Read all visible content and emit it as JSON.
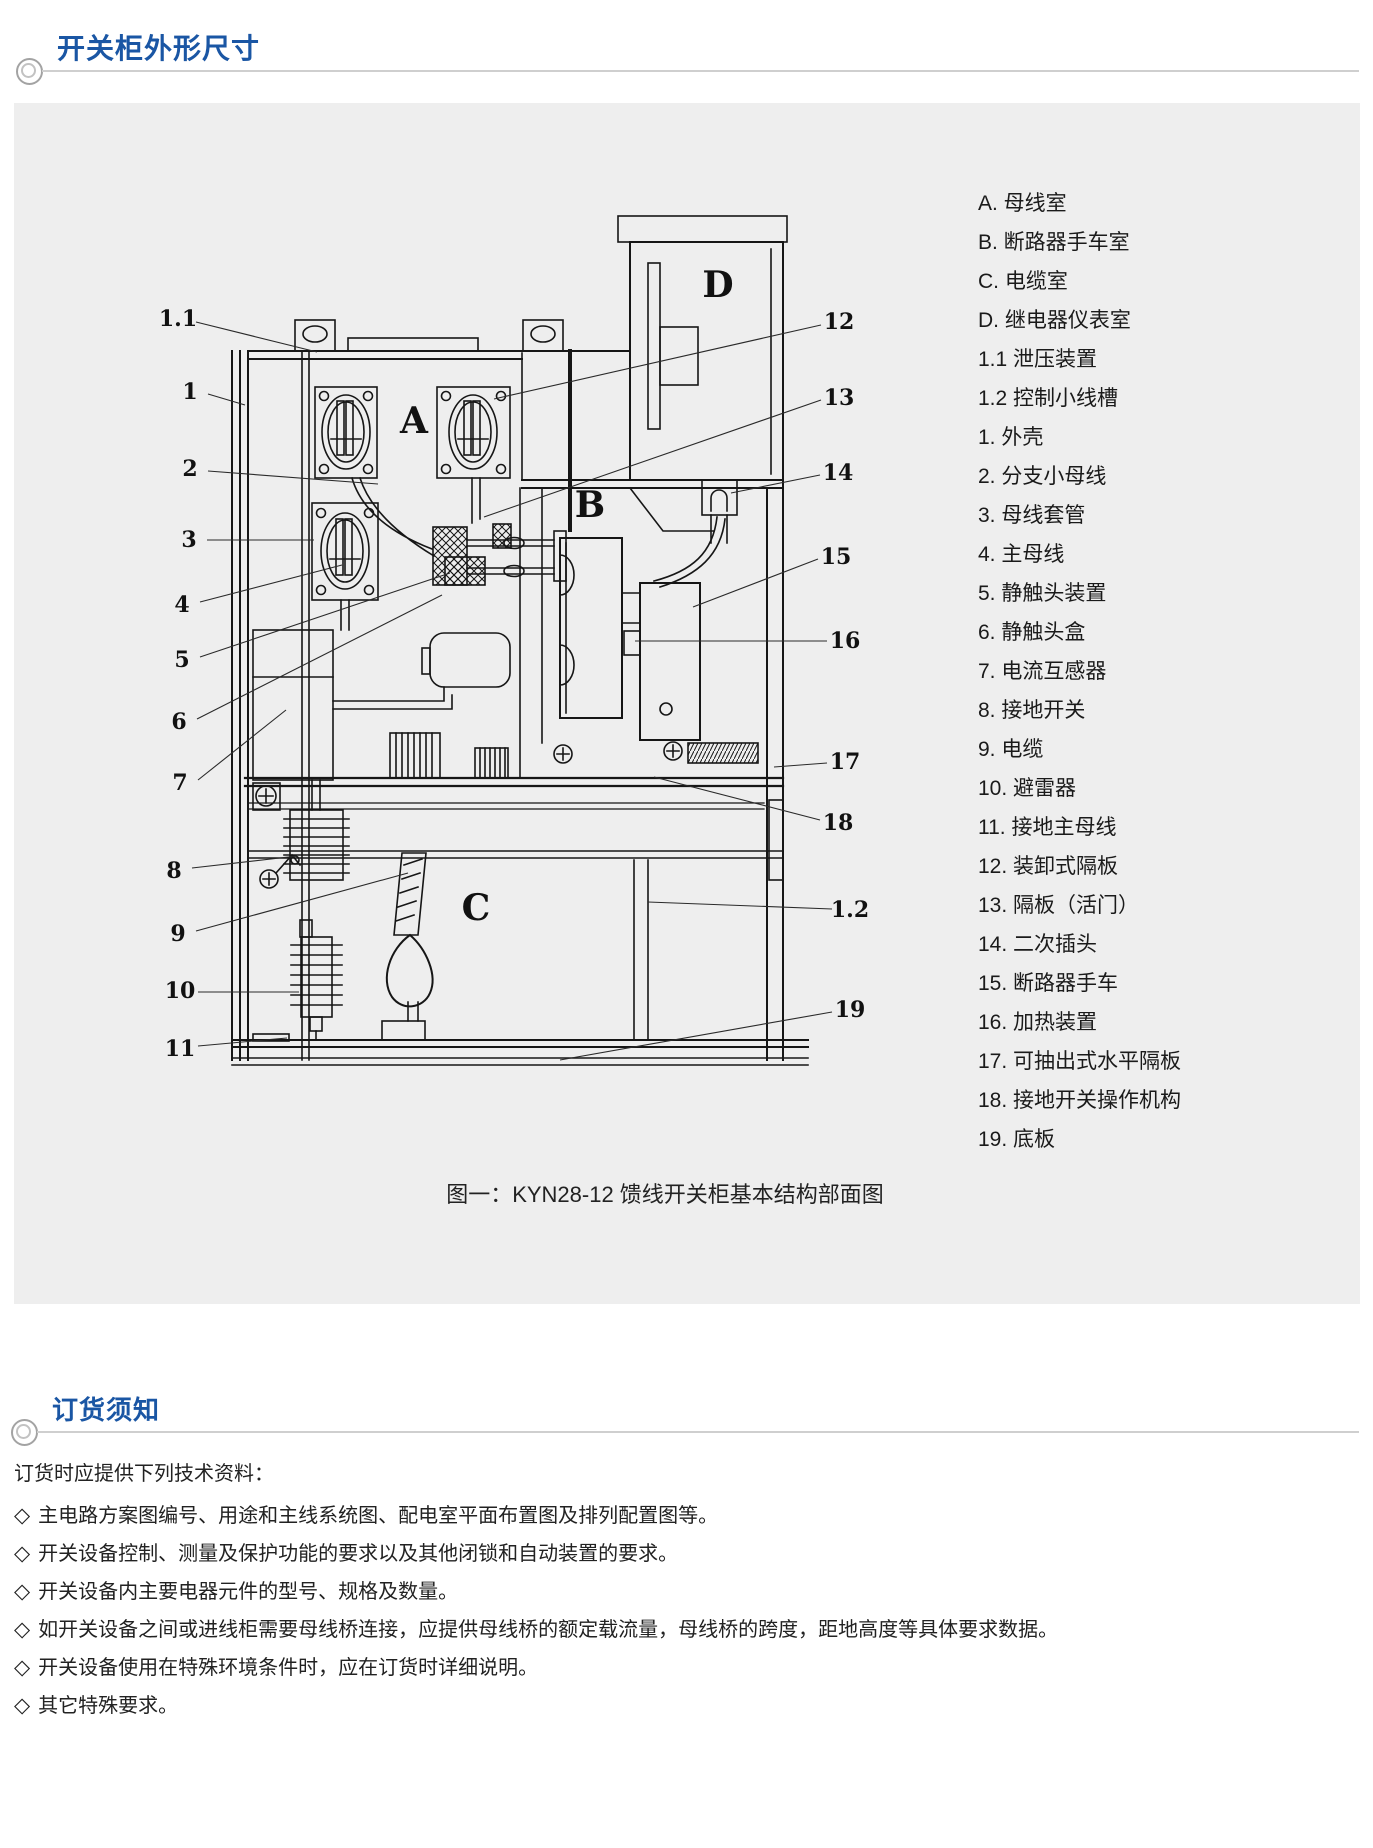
{
  "sections": {
    "dimensions_title": "开关柜外形尺寸",
    "ordering_title": "订货须知"
  },
  "diagram": {
    "compartment_letters": [
      "A",
      "B",
      "C",
      "D"
    ],
    "callouts_left": [
      "1.1",
      "1",
      "2",
      "3",
      "4",
      "5",
      "6",
      "7",
      "8",
      "9",
      "10",
      "11"
    ],
    "callouts_right": [
      "12",
      "13",
      "14",
      "15",
      "16",
      "17",
      "18",
      "1.2",
      "19"
    ],
    "caption": "图一：KYN28-12 馈线开关柜基本结构部面图"
  },
  "legend": {
    "items": [
      "A. 母线室",
      "B. 断路器手车室",
      "C. 电缆室",
      "D. 继电器仪表室",
      "1.1 泄压装置",
      "1.2 控制小线槽",
      "1. 外壳",
      "2. 分支小母线",
      "3. 母线套管",
      "4. 主母线",
      "5. 静触头装置",
      "6. 静触头盒",
      "7. 电流互感器",
      "8. 接地开关",
      "9. 电缆",
      "10. 避雷器",
      "11. 接地主母线",
      "12. 装卸式隔板",
      "13. 隔板（活门）",
      "14. 二次插头",
      "15. 断路器手车",
      "16. 加热装置",
      "17. 可抽出式水平隔板",
      "18. 接地开关操作机构",
      "19. 底板"
    ]
  },
  "ordering": {
    "intro": "订货时应提供下列技术资料：",
    "bullet": "◇",
    "items": [
      "主电路方案图编号、用途和主线系统图、配电室平面布置图及排列配置图等。",
      "开关设备控制、测量及保护功能的要求以及其他闭锁和自动装置的要求。",
      "开关设备内主要电器元件的型号、规格及数量。",
      "如开关设备之间或进线柜需要母线桥连接，应提供母线桥的额定载流量，母线桥的跨度，距地高度等具体要求数据。",
      "开关设备使用在特殊环境条件时，应在订货时详细说明。",
      "其它特殊要求。"
    ]
  },
  "colors": {
    "accent_blue": "#1a56a4",
    "panel_background": "#eeeeee",
    "rule_gray": "#cfcfcf",
    "diagram_ink": "#161616"
  }
}
